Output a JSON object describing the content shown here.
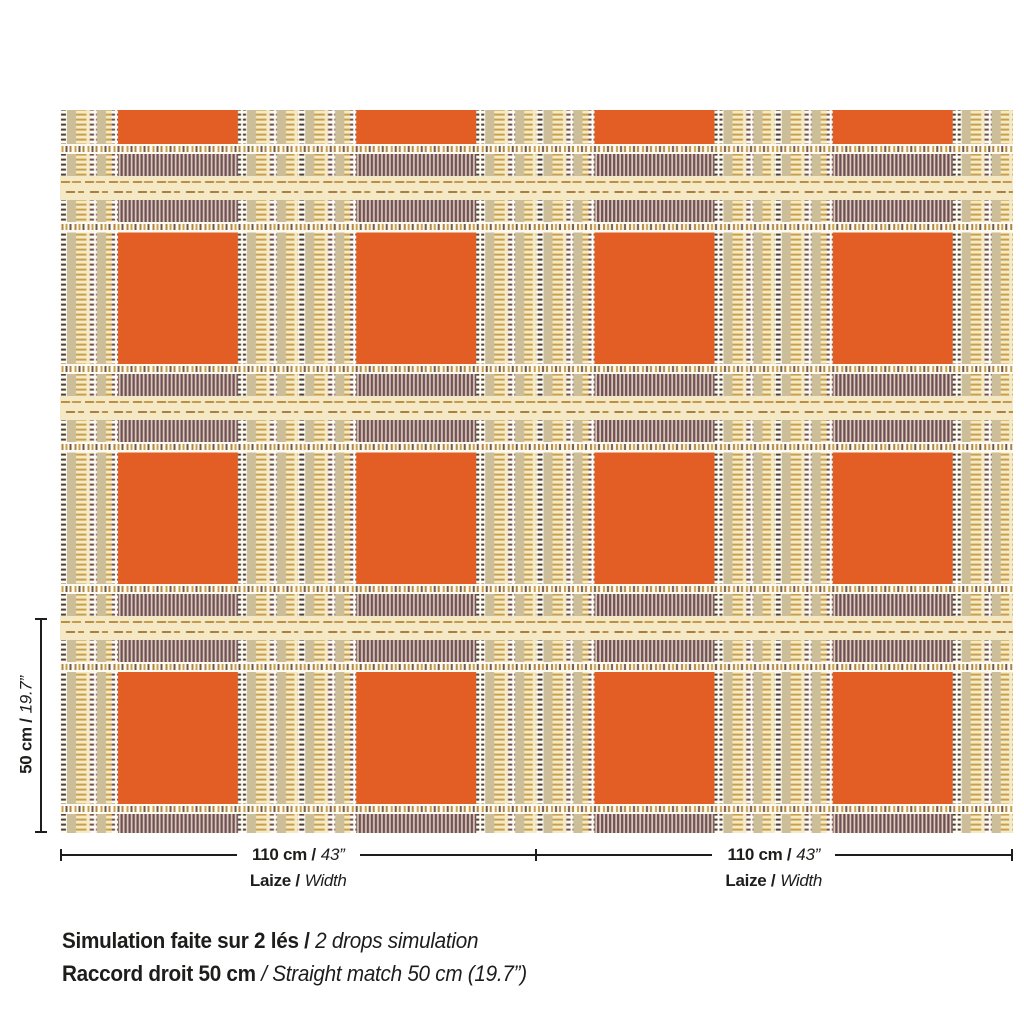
{
  "colors": {
    "background": "#FFFFFF",
    "orange": "#E25E24",
    "tan": "#CCBE98",
    "cream_ladder_bg": "#F4EBC6",
    "gold_dash": "#CA9E4B",
    "dark_dash": "#4C3E38",
    "plum_hatch": "#6F4F57",
    "hatch_bg": "#E0D0BB",
    "white_band": "#FDFBF1",
    "minidash_bg": "#F4E9C4",
    "minidash_dash": "#BC8E41",
    "dimension_line": "#1D1D1B",
    "text": "#1D1D1B"
  },
  "vertical_dimension": {
    "bold": "50 cm /",
    "italic": "19.7”"
  },
  "horizontal_dimensions": [
    {
      "bold": "110 cm /",
      "italic": "43”",
      "label_bold": "Laize /",
      "label_italic": "Width"
    },
    {
      "bold": "110 cm /",
      "italic": "43”",
      "label_bold": "Laize /",
      "label_italic": "Width"
    }
  ],
  "caption": {
    "line1_bold": "Simulation faite sur 2 lés /",
    "line1_italic": "2 drops simulation",
    "line2_bold": "Raccord droit 50 cm",
    "line2_italic": "/ Straight match 50 cm (19.7”)"
  }
}
